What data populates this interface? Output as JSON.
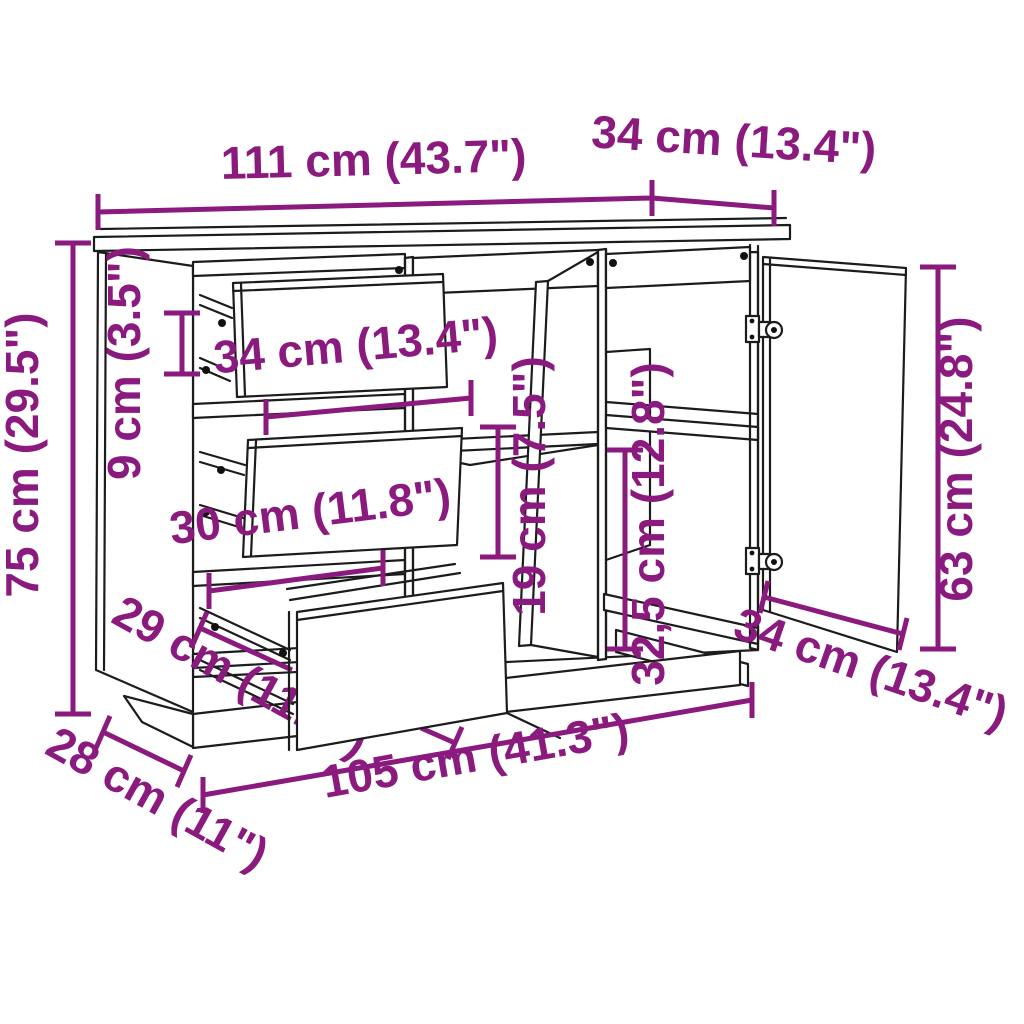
{
  "diagram_title": "sideboard-dimension-diagram",
  "accent_color": "#8A1A7D",
  "line_color": "#1c1c1c",
  "background_color": "#ffffff",
  "dimensions": {
    "top_width": "111 cm (43.7\")",
    "top_depth": "34 cm (13.4\")",
    "height": "75 cm (29.5\")",
    "front_rail_height": "9 cm (3.5\")",
    "drawer_front_width": "34 cm (13.4\")",
    "drawer_inner_width": "30 cm (11.8\")",
    "drawer_side_depth": "29 cm (11.4\")",
    "plinth_depth": "28 cm (11\")",
    "plinth_width": "105 cm (41.3\")",
    "middle_shelf_clearance": "19 cm (7.5\")",
    "right_shelf_clearance": "32,5 cm (12.8\")",
    "door_width": "34 cm (13.4\")",
    "door_height": "63 cm (24.8\")"
  }
}
